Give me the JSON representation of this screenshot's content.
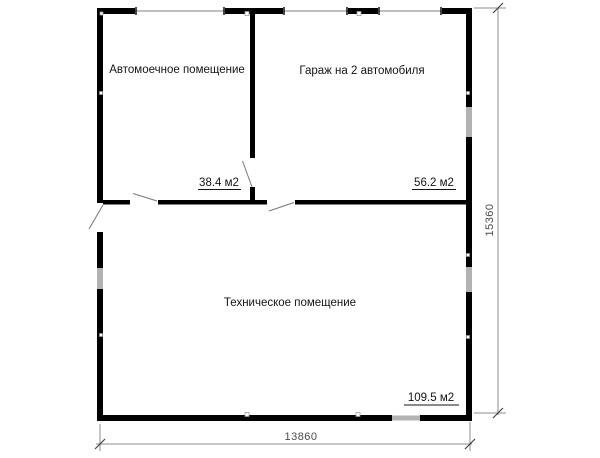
{
  "plan": {
    "rooms": [
      {
        "id": "carwash",
        "name": "Автомоечное помещение",
        "area": "38.4 м2"
      },
      {
        "id": "garage",
        "name": "Гараж на 2 автомобиля",
        "area": "56.2 м2"
      },
      {
        "id": "technical",
        "name": "Техническое помещение",
        "area": "109.5 м2"
      }
    ],
    "dimensions": {
      "bottom_width": "13860",
      "right_height": "15360"
    },
    "colors": {
      "wall": "#000000",
      "window": "#b2b2b2",
      "opening_line": "#9a9a9a",
      "door_swing": "#777777",
      "dimension_line": "#8c8c8c",
      "dimension_tick": "#444444",
      "dimension_text": "#4a4a4a",
      "label_text": "#141414"
    }
  }
}
